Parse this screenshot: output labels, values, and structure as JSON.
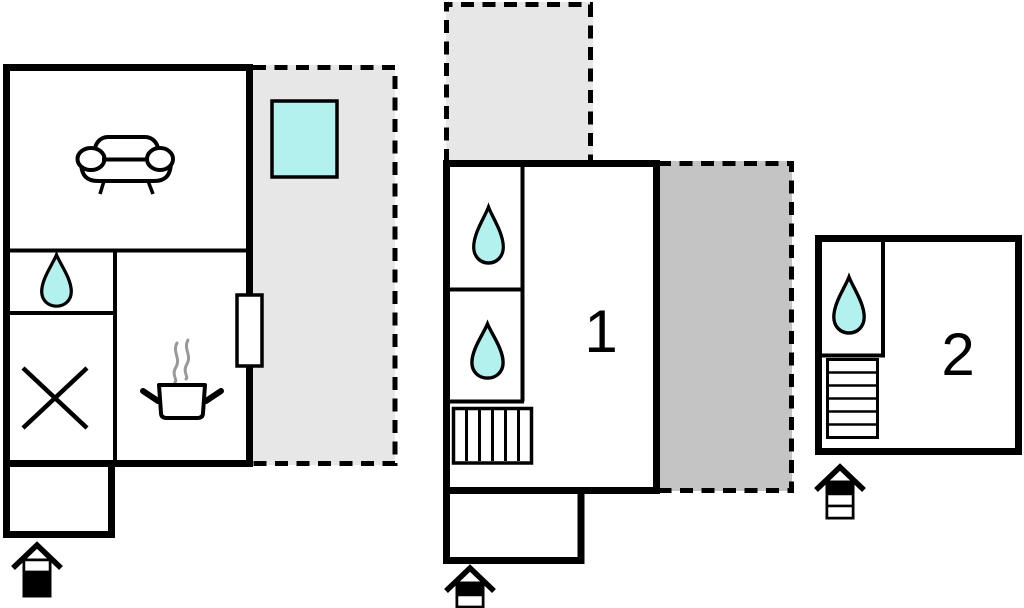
{
  "page": {
    "type": "floor-plan",
    "background": "#ffffff"
  },
  "colors": {
    "wall": "#000000",
    "water": "#b3f1ef",
    "terrace_light": "#e7e7e7",
    "terrace_dark": "#c4c4c4",
    "steam": "#999999",
    "room_fill": "#ffffff"
  },
  "plan": {
    "buildings": [
      {
        "name": "main-house",
        "label": "",
        "features": [
          "sofa",
          "water-drop",
          "cross-mark",
          "cooking-pot",
          "door",
          "terrace",
          "whirlpool",
          "entrance-arrow"
        ]
      },
      {
        "name": "apartment-1",
        "label": "1",
        "features": [
          "water-drop",
          "water-drop",
          "stairs",
          "terrace-top",
          "terrace-right",
          "entrance-arrow"
        ]
      },
      {
        "name": "apartment-2",
        "label": "2",
        "features": [
          "water-drop",
          "stairs",
          "entrance-arrow"
        ]
      }
    ]
  },
  "entrance_arrows": [
    {
      "bands": [
        "#ffffff",
        "#000000",
        "#000000"
      ]
    },
    {
      "bands": [
        "#000000",
        "#ffffff",
        "#ffffff"
      ]
    },
    {
      "bands": [
        "#000000",
        "#ffffff",
        "#ffffff"
      ]
    }
  ]
}
